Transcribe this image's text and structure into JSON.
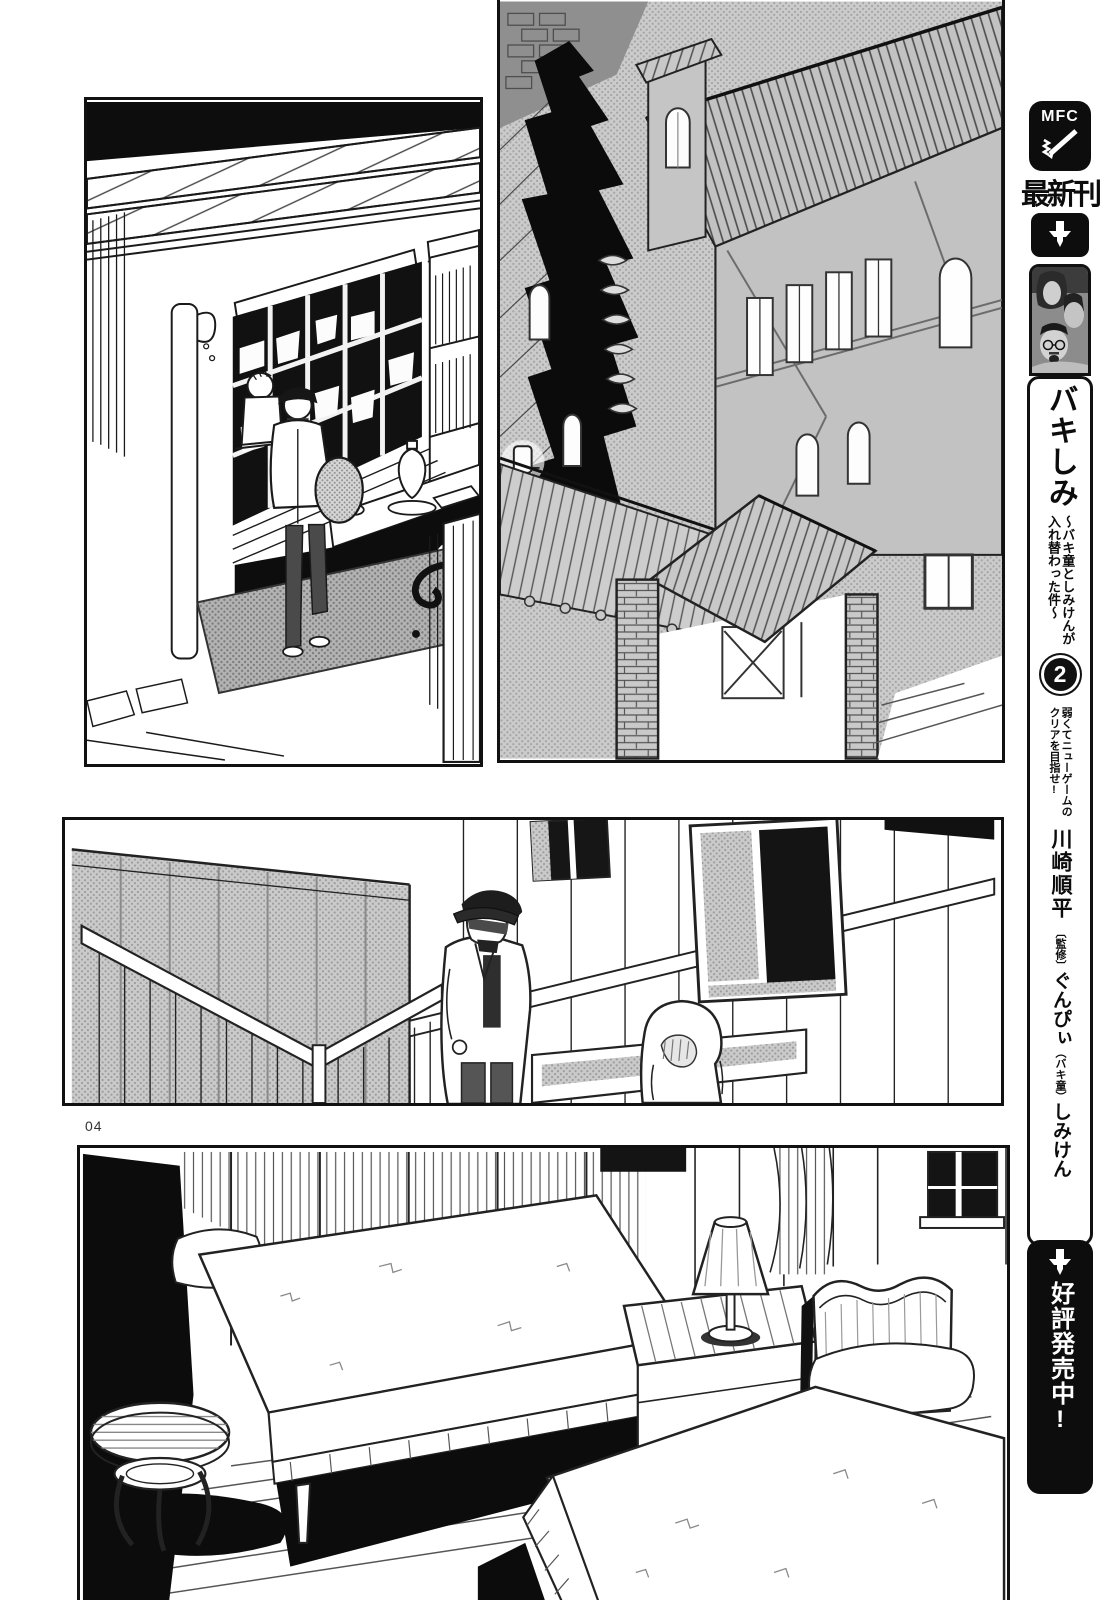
{
  "colors": {
    "ink": "#111111",
    "paper": "#ffffff",
    "halftone_gray": "#c6c6c6"
  },
  "page": {
    "number_label": "04"
  },
  "panels": [
    {
      "name": "shop-counter-scene"
    },
    {
      "name": "night-town-buildings"
    },
    {
      "name": "two-travelers-walking"
    },
    {
      "name": "inn-bedroom-two-beds"
    }
  ],
  "sidebar": {
    "logo_text": "MFC",
    "latest_label": "最新刊",
    "book": {
      "title": "バキしみ",
      "subtitle_col_right": "～バキ童としみけんが",
      "subtitle_col_left": "入れ替わった件～",
      "volume_number": "2",
      "tagline_col_right": "弱くてニューゲームの",
      "tagline_col_left": "クリアを目指せ!"
    },
    "credits": {
      "author": "川崎順平",
      "supervisor_label": "〔監修〕",
      "supervisor_name": "ぐんぴぃ",
      "supervisor_note": "（バキ童）",
      "co_author": "しみけん"
    },
    "sale_label": "好評発売中!"
  }
}
